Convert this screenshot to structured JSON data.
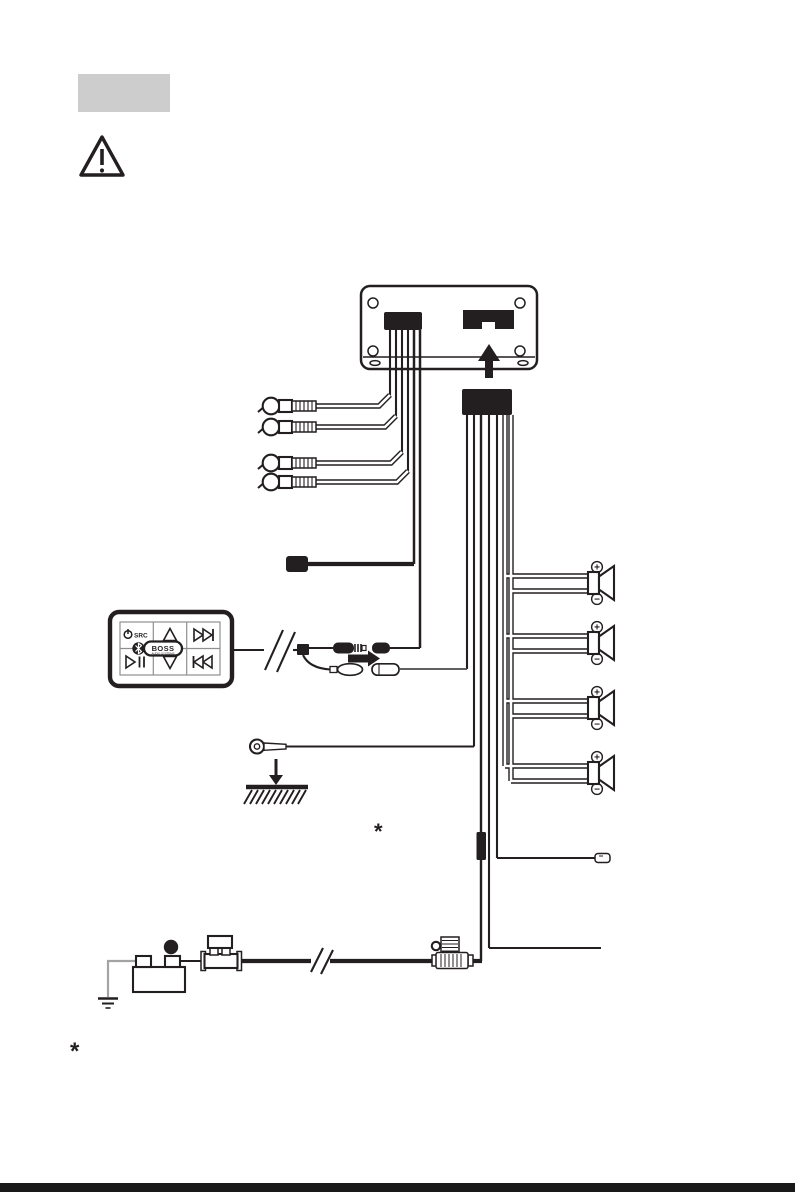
{
  "page": {
    "background": "#ffffff",
    "ink_color": "#231f20",
    "heading_placeholder_color": "#cdcdcd",
    "bottom_edge_color": "#191919"
  },
  "remote_control": {
    "source_button_label": "SRC",
    "brand": "BOSS",
    "brand_subtitle": "AUDIO SYSTEMS"
  },
  "battery": {
    "positive_terminal_label": "+"
  },
  "speakers": {
    "count": 4,
    "positive_label": "+",
    "negative_label": "−"
  },
  "annotations": {
    "diagram_footnote_marker": "*",
    "page_footnote_marker": "*"
  }
}
